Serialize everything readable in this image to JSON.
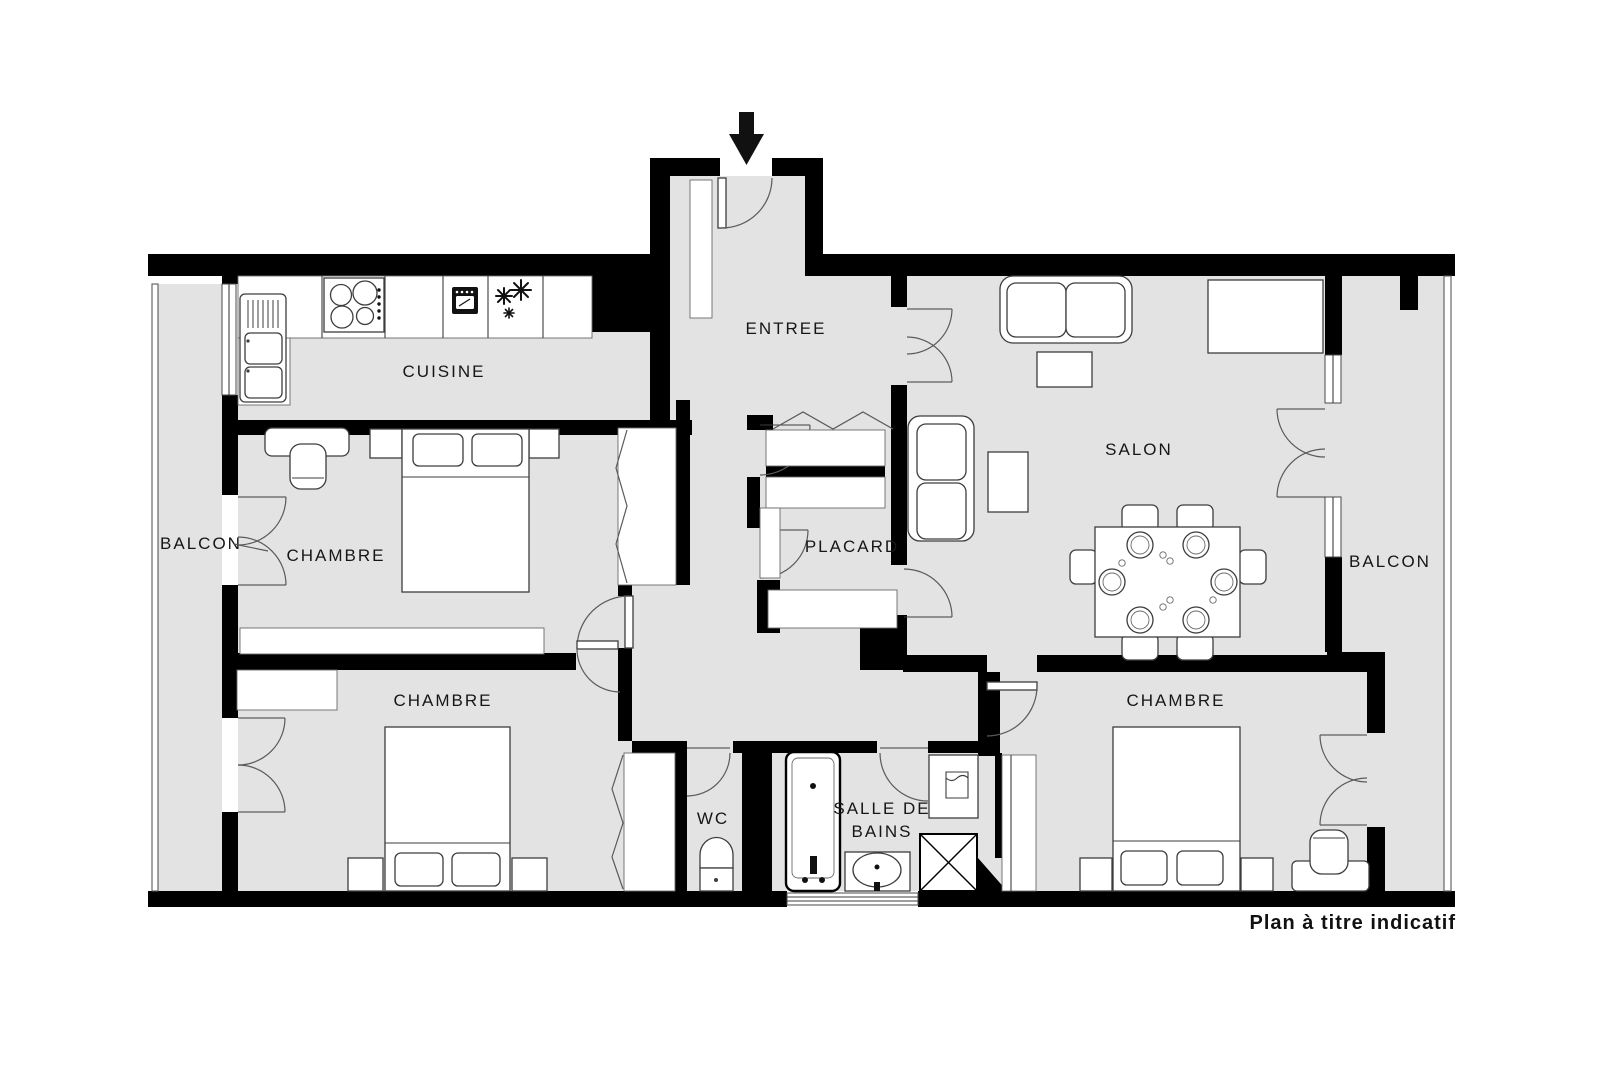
{
  "title": "Floor plan",
  "footer": {
    "note": "Plan à titre indicatif"
  },
  "rooms": {
    "cuisine": {
      "label": "CUISINE"
    },
    "entree": {
      "label": "ENTREE"
    },
    "salon": {
      "label": "SALON"
    },
    "placard": {
      "label": "PLACARD"
    },
    "balcon_left": {
      "label": "BALCON"
    },
    "balcon_right": {
      "label": "BALCON"
    },
    "chambre_top_left": {
      "label": "CHAMBRE"
    },
    "chambre_bottom_left": {
      "label": "CHAMBRE"
    },
    "chambre_bottom_right": {
      "label": "CHAMBRE"
    },
    "wc": {
      "label": "WC"
    },
    "salle_de_bains": {
      "line1": "SALLE DE",
      "line2": "BAINS"
    }
  },
  "icons": {
    "entrance_arrow": "arrow-down",
    "stove": "4-burner-hob",
    "oven": "oven",
    "freezer": "snowflakes",
    "sink": "double-sink",
    "toilet": "wc-toilet",
    "bathtub": "bathtub",
    "washbasin": "washbasin",
    "washing_machine": "crossed-square"
  },
  "colors": {
    "floor": "#e3e3e3",
    "wall": "#000000",
    "furniture_stroke": "#3d3d3d",
    "label": "#161616"
  }
}
